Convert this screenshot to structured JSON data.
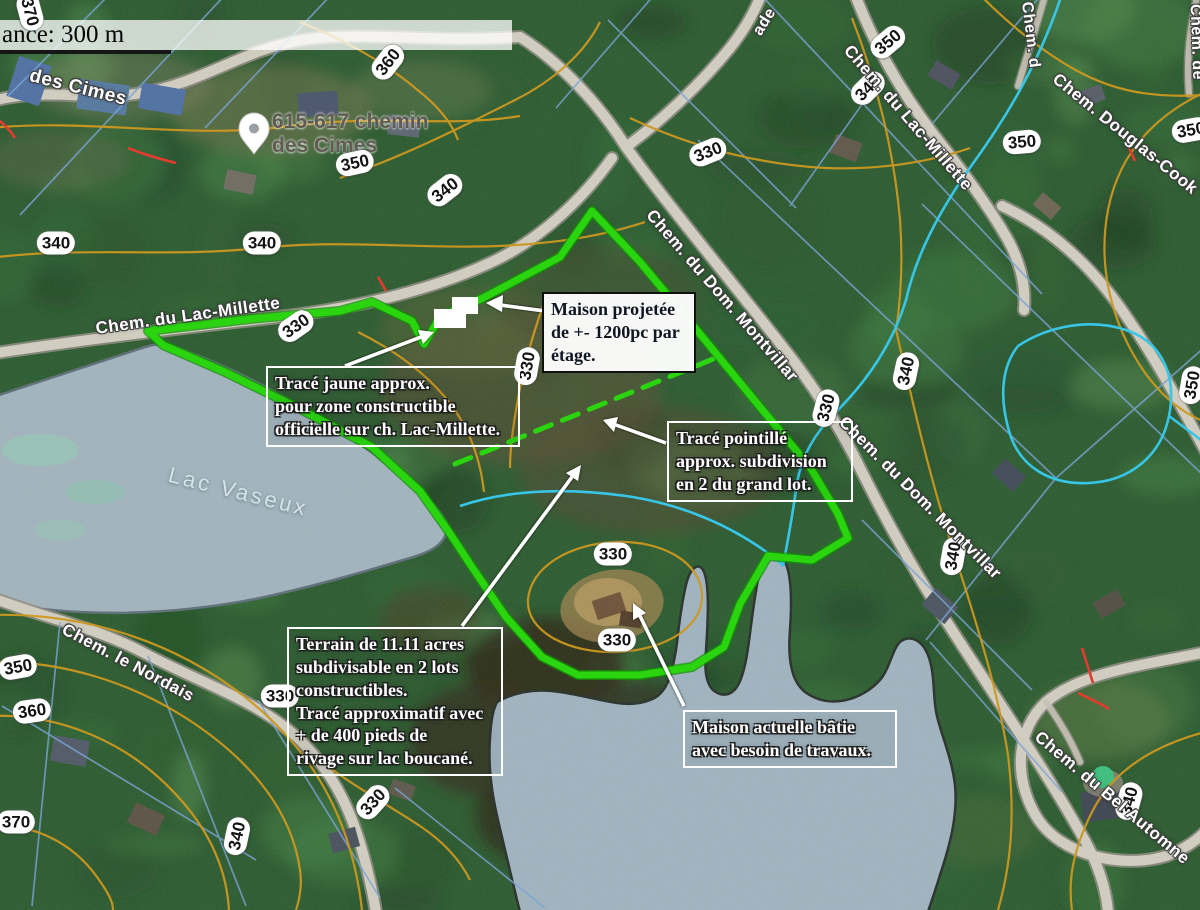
{
  "map": {
    "scale_bar": {
      "text": "ance: 300 m"
    },
    "pin": {
      "label_line1": "615-617 chemin",
      "label_line2": "des Cimes"
    },
    "lake_label": "Lac Vaseux",
    "road_labels": [
      {
        "text": "des Cimes",
        "x": 78,
        "y": 88,
        "rot": 14,
        "size": 19
      },
      {
        "text": "Chem. du Lac-Millette",
        "x": 188,
        "y": 316,
        "rot": -8,
        "size": 17
      },
      {
        "text": "Chem. du Lac-Millette",
        "x": 908,
        "y": 118,
        "rot": 49,
        "size": 17
      },
      {
        "text": "Chem. Douglas-Cook",
        "x": 1125,
        "y": 134,
        "rot": 39,
        "size": 17
      },
      {
        "text": "Chem. d",
        "x": 1030,
        "y": 35,
        "rot": 83,
        "size": 16
      },
      {
        "text": "Chem. de",
        "x": 1196,
        "y": 42,
        "rot": 88,
        "size": 16
      },
      {
        "text": "ade",
        "x": 765,
        "y": 22,
        "rot": -58,
        "size": 16
      },
      {
        "text": "Chem. du Dom. Montvillar",
        "x": 722,
        "y": 296,
        "rot": 49,
        "size": 17
      },
      {
        "text": "Chem. du Dom. Montvillar",
        "x": 920,
        "y": 498,
        "rot": 45,
        "size": 17
      },
      {
        "text": "Chem. le Nordais",
        "x": 128,
        "y": 663,
        "rot": 28,
        "size": 17
      },
      {
        "text": "Chem. du Bel Automne",
        "x": 1112,
        "y": 798,
        "rot": 40,
        "size": 17
      }
    ],
    "contour_badges": [
      {
        "label": "370",
        "x": 30,
        "y": 12,
        "rot": 75
      },
      {
        "label": "360",
        "x": 388,
        "y": 62,
        "rot": -52
      },
      {
        "label": "350",
        "x": 888,
        "y": 42,
        "rot": -40
      },
      {
        "label": "340",
        "x": 868,
        "y": 88,
        "rot": -45
      },
      {
        "label": "340",
        "x": 445,
        "y": 190,
        "rot": -38
      },
      {
        "label": "350",
        "x": 355,
        "y": 163,
        "rot": -12
      },
      {
        "label": "350",
        "x": 1022,
        "y": 142,
        "rot": -5
      },
      {
        "label": "350",
        "x": 1191,
        "y": 130,
        "rot": -10
      },
      {
        "label": "340",
        "x": 56,
        "y": 243,
        "rot": 0
      },
      {
        "label": "340",
        "x": 262,
        "y": 243,
        "rot": 0
      },
      {
        "label": "330",
        "x": 708,
        "y": 152,
        "rot": -22
      },
      {
        "label": "330",
        "x": 296,
        "y": 326,
        "rot": -35
      },
      {
        "label": "330",
        "x": 527,
        "y": 366,
        "rot": -80
      },
      {
        "label": "340",
        "x": 906,
        "y": 371,
        "rot": -78
      },
      {
        "label": "330",
        "x": 826,
        "y": 408,
        "rot": -75
      },
      {
        "label": "350",
        "x": 1192,
        "y": 385,
        "rot": -80
      },
      {
        "label": "340",
        "x": 953,
        "y": 556,
        "rot": -80
      },
      {
        "label": "330",
        "x": 613,
        "y": 554,
        "rot": 0
      },
      {
        "label": "330",
        "x": 617,
        "y": 640,
        "rot": 0
      },
      {
        "label": "330",
        "x": 280,
        "y": 696,
        "rot": 0
      },
      {
        "label": "350",
        "x": 18,
        "y": 667,
        "rot": -10
      },
      {
        "label": "360",
        "x": 32,
        "y": 711,
        "rot": -8
      },
      {
        "label": "370",
        "x": 16,
        "y": 822,
        "rot": 0
      },
      {
        "label": "340",
        "x": 237,
        "y": 836,
        "rot": -78
      },
      {
        "label": "330",
        "x": 373,
        "y": 802,
        "rot": -48
      },
      {
        "label": "340",
        "x": 1129,
        "y": 801,
        "rot": -75
      }
    ],
    "colors": {
      "boundary_green": "#2ad50f",
      "contour_orange": "#cc9820",
      "stream_cyan": "#38c6e8",
      "parcel_blue": "#7aa4d4",
      "annotation_red": "#e23b30"
    }
  },
  "annotations": {
    "boxes": [
      {
        "id": "maison-projetee",
        "style": "solid",
        "x": 542,
        "y": 292,
        "w": 136,
        "text": "Maison projetée\nde +- 1200pc par\nétage."
      },
      {
        "id": "trace-jaune",
        "style": "outline",
        "x": 266,
        "y": 366,
        "w": 236,
        "text": "Tracé jaune approx.\npour zone constructible\nofficielle sur ch. Lac-Millette."
      },
      {
        "id": "trace-pointille",
        "style": "outline",
        "x": 667,
        "y": 421,
        "w": 168,
        "text": "Tracé pointillé\napprox. subdivision\nen 2 du grand lot."
      },
      {
        "id": "terrain",
        "style": "outline",
        "x": 287,
        "y": 627,
        "w": 198,
        "text": "Terrain de 11.11 acres\nsubdivisable en 2 lots\nconstructibles.\nTracé approximatif avec\n+ de 400 pieds de\nrivage sur lac boucané."
      },
      {
        "id": "maison-actuelle",
        "style": "outline",
        "x": 683,
        "y": 710,
        "w": 196,
        "text": "Maison actuelle bâtie\navec besoin de travaux."
      }
    ]
  }
}
